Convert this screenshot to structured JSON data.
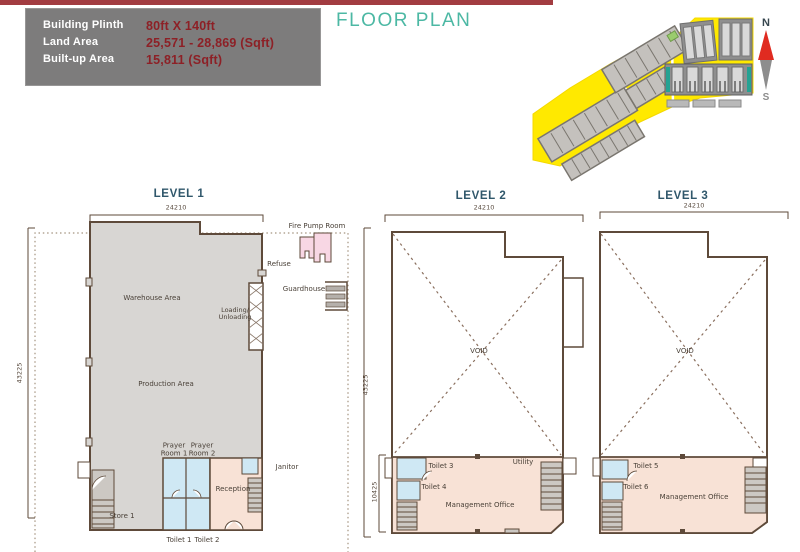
{
  "header": {
    "title": "FLOOR PLAN",
    "specs": [
      {
        "label": "Building Plinth",
        "value": "80ft X 140ft"
      },
      {
        "label": "Land Area",
        "value": "25,571 - 28,869 (Sqft)"
      },
      {
        "label": "Built-up Area",
        "value": "15,811 (Sqft)"
      }
    ]
  },
  "compass": {
    "north": "N",
    "south": "S"
  },
  "level1": {
    "title": "LEVEL 1",
    "dims": {
      "width": "24210",
      "height": "43225"
    },
    "labels": {
      "fire_pump_room": "Fire Pump Room",
      "refuse": "Refuse",
      "guardhouse": "Guardhouse",
      "warehouse": "Warehouse Area",
      "loading": "Loading/\nUnloading",
      "production": "Production Area",
      "prayer1": "Prayer\nRoom 1",
      "prayer2": "Prayer\nRoom 2",
      "janitor": "Janitor",
      "reception": "Reception",
      "store": "Store 1",
      "toilet1": "Toilet 1",
      "toilet2": "Toilet 2"
    }
  },
  "level2": {
    "title": "LEVEL 2",
    "dims": {
      "width": "24210",
      "height": "43225",
      "office": "10425"
    },
    "labels": {
      "void": "VOID",
      "toilet3": "Toilet 3",
      "toilet4": "Toilet 4",
      "utility": "Utility",
      "office": "Management Office"
    }
  },
  "level3": {
    "title": "LEVEL 3",
    "dims": {
      "width": "24210"
    },
    "labels": {
      "void": "VOID",
      "toilet5": "Toilet 5",
      "toilet6": "Toilet 6",
      "office": "Management Office"
    }
  },
  "colors": {
    "accent_red": "#a23c41",
    "value_red": "#8d2026",
    "teal": "#4cb8a4",
    "navy": "#30576b",
    "wall_brown": "#5e4a3a",
    "floor_gray": "#d8d6d3",
    "room_blue": "#cfe8f4",
    "room_peach": "#f8e2d6",
    "room_pink": "#f8d7e4",
    "site_yellow": "#ffe900"
  }
}
